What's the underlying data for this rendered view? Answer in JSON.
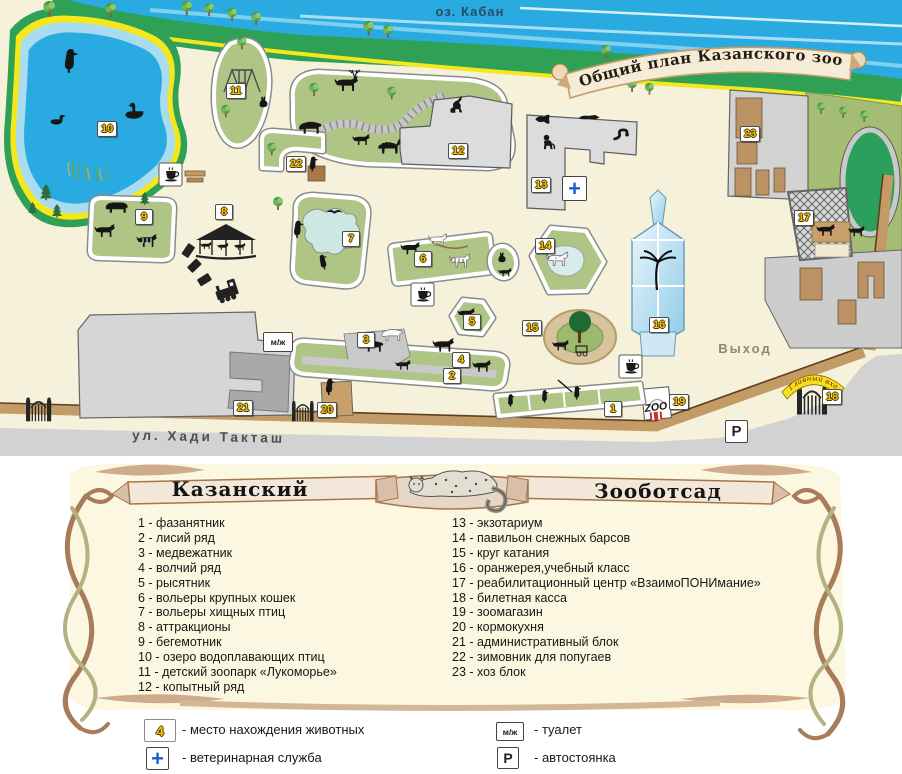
{
  "banner": {
    "title": "Общий план Казанского зооботсада"
  },
  "map": {
    "lake_name": "оз. Кабан",
    "street_name": "ул. Хади Такташ",
    "exit_label": "Выход",
    "main_entrance_label": "Главный вход",
    "zoo_shop_sign": "ZOO",
    "parking_symbol": "P",
    "toilet_symbol": "м/ж",
    "vet_symbol": "+",
    "markers": {
      "m1": "1",
      "m2": "2",
      "m3": "3",
      "m4": "4",
      "m5": "5",
      "m6": "6",
      "m7": "7",
      "m8": "8",
      "m9": "9",
      "m10": "10",
      "m11": "11",
      "m12": "12",
      "m13": "13",
      "m14": "14",
      "m15": "15",
      "m16": "16",
      "m17": "17",
      "m18": "18",
      "m19": "19",
      "m20": "20",
      "m21": "21",
      "m22": "22",
      "m23": "23"
    }
  },
  "legend": {
    "title_left": "Казанский",
    "title_right": "Зооботсад",
    "items_left": [
      "1 - фазанятник",
      "2 - лисий ряд",
      "3 - медвежатник",
      "4 - волчий ряд",
      "5 - рысятник",
      "6 - вольеры крупных кошек",
      "7 - вольеры хищных птиц",
      "8 - аттракционы",
      "9 - бегемотник",
      "10 - озеро водоплавающих птиц",
      "11 - детский зоопарк «Лукоморье»",
      "12 - копытный ряд"
    ],
    "items_right": [
      "13 - экзотариум",
      "14 - павильон снежных барсов",
      "15 - круг катания",
      "16 - оранжерея,учебный класс",
      "17 - реабилитационный центр «ВзаимоПОНИмание»",
      "18 - билетная касса",
      "19 - зоомагазин",
      "20 - кормокухня",
      "21 - административный блок",
      "22 - зимовник для попугаев",
      "23 - хоз блок"
    ]
  },
  "key": {
    "animal_symbol": "4",
    "animal_text": "- место нахождения животных",
    "vet_symbol": "+",
    "vet_text": "- ветеринарная служба",
    "toilet_symbol": "м/ж",
    "toilet_text": "- туалет",
    "parking_symbol": "P",
    "parking_text": "- автостоянка"
  },
  "colors": {
    "water": "#29abe2",
    "shore_green": "#2fa156",
    "shore_yellow": "#f4e81c",
    "enclosure_green": "#afc586",
    "marker_yellow": "#f2c20d",
    "vet_blue": "#1d5fd0",
    "entrance_yellow": "#f7e11c",
    "frame_brown": "#a87c58",
    "panel_cream": "#fcf7e0"
  }
}
